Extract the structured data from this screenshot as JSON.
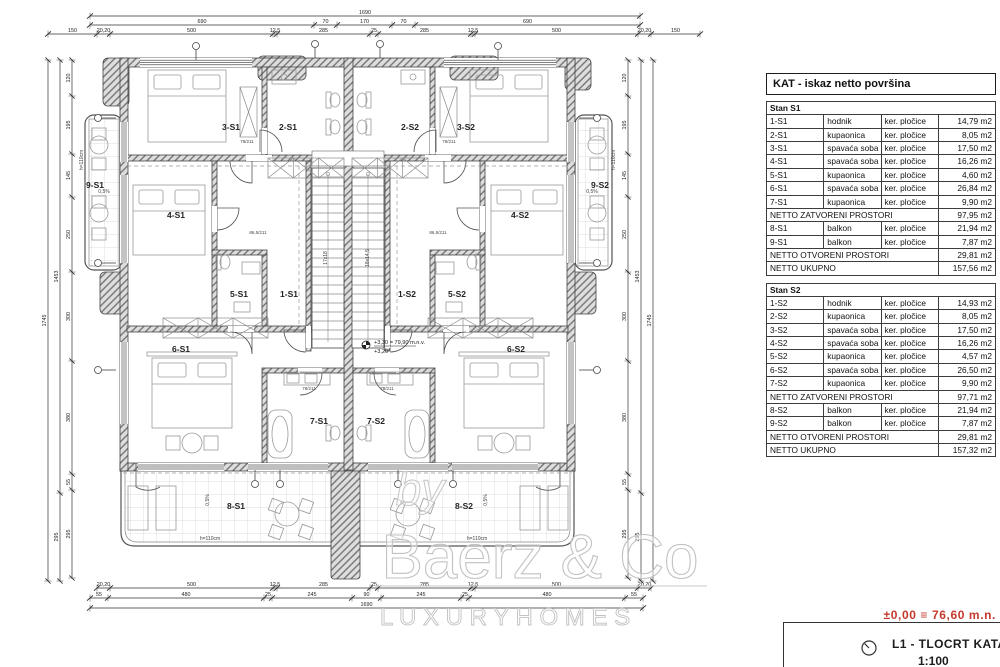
{
  "colors": {
    "benchmark_red": "#c43a2e",
    "wall_line": "#444444",
    "thin_line": "#555555"
  },
  "panel": {
    "header": "KAT - iskaz netto površina",
    "units": [
      {
        "title": "Stan S1",
        "rows": [
          {
            "code": "1-S1",
            "name": "hodnik",
            "finish": "ker. pločice",
            "area": "14,79 m2"
          },
          {
            "code": "2-S1",
            "name": "kupaonica",
            "finish": "ker. pločice",
            "area": "8,05 m2"
          },
          {
            "code": "3-S1",
            "name": "spavaća soba",
            "finish": "ker. pločice",
            "area": "17,50 m2"
          },
          {
            "code": "4-S1",
            "name": "spavaća soba",
            "finish": "ker. pločice",
            "area": "16,26 m2"
          },
          {
            "code": "5-S1",
            "name": "kupaonica",
            "finish": "ker. pločice",
            "area": "4,60 m2"
          },
          {
            "code": "6-S1",
            "name": "spavaća soba",
            "finish": "ker. pločice",
            "area": "26,84 m2"
          },
          {
            "code": "7-S1",
            "name": "kupaonica",
            "finish": "ker. pločice",
            "area": "9,90 m2"
          }
        ],
        "closed": {
          "label": "NETTO ZATVORENI PROSTORI",
          "area": "97,95 m2"
        },
        "open_rows": [
          {
            "code": "8-S1",
            "name": "balkon",
            "finish": "ker. pločice",
            "area": "21,94 m2"
          },
          {
            "code": "9-S1",
            "name": "balkon",
            "finish": "ker. pločice",
            "area": "7,87 m2"
          }
        ],
        "open": {
          "label": "NETTO OTVORENI PROSTORI",
          "area": "29,81 m2"
        },
        "total": {
          "label": "NETTO UKUPNO",
          "area": "157,56 m2"
        }
      },
      {
        "title": "Stan S2",
        "rows": [
          {
            "code": "1-S2",
            "name": "hodnik",
            "finish": "ker. pločice",
            "area": "14,93 m2"
          },
          {
            "code": "2-S2",
            "name": "kupaonica",
            "finish": "ker. pločice",
            "area": "8,05 m2"
          },
          {
            "code": "3-S2",
            "name": "spavaća soba",
            "finish": "ker. pločice",
            "area": "17,50 m2"
          },
          {
            "code": "4-S2",
            "name": "spavaća soba",
            "finish": "ker. pločice",
            "area": "16,26 m2"
          },
          {
            "code": "5-S2",
            "name": "kupaonica",
            "finish": "ker. pločice",
            "area": "4,57 m2"
          },
          {
            "code": "6-S2",
            "name": "spavaća soba",
            "finish": "ker. pločice",
            "area": "26,50 m2"
          },
          {
            "code": "7-S2",
            "name": "kupaonica",
            "finish": "ker. pločice",
            "area": "9,90 m2"
          }
        ],
        "closed": {
          "label": "NETTO ZATVORENI PROSTORI",
          "area": "97,71 m2"
        },
        "open_rows": [
          {
            "code": "8-S2",
            "name": "balkon",
            "finish": "ker. pločice",
            "area": "21,94 m2"
          },
          {
            "code": "9-S2",
            "name": "balkon",
            "finish": "ker. pločice",
            "area": "7,87 m2"
          }
        ],
        "open": {
          "label": "NETTO OTVORENI PROSTORI",
          "area": "29,81 m2"
        },
        "total": {
          "label": "NETTO UKUPNO",
          "area": "157,32 m2"
        }
      }
    ]
  },
  "plan": {
    "rooms": [
      "3-S1",
      "2-S1",
      "2-S2",
      "3-S2",
      "4-S1",
      "4-S2",
      "9-S1",
      "9-S2",
      "5-S1",
      "1-S1",
      "1-S2",
      "5-S2",
      "6-S1",
      "6-S2",
      "7-S1",
      "7-S2",
      "8-S1",
      "8-S2"
    ],
    "dims": {
      "top1": [
        "1690"
      ],
      "top2": [
        "690",
        "70",
        "170",
        "70",
        "690"
      ],
      "top3": [
        "150",
        "20,20",
        "500",
        "12,5",
        "285",
        "25",
        "285",
        "12,5",
        "500",
        "20,20",
        "150"
      ],
      "bottom1": [
        "20,20",
        "500",
        "12,5",
        "285",
        "25",
        "285",
        "12,5",
        "500",
        "20,20"
      ],
      "bottom2": [
        "55",
        "480",
        "25",
        "245",
        "90",
        "245",
        "25",
        "480",
        "55"
      ],
      "bottom3": [
        "1690"
      ],
      "side_a": [
        "120",
        "195",
        "145",
        "250",
        "300",
        "380",
        "55",
        "295"
      ],
      "side_b": [
        "1453",
        "295"
      ],
      "side_c": [
        "1745"
      ]
    },
    "notes": {
      "level": "+3,30 = 79,90 m.n.v.",
      "level2": "+3,20",
      "slope": "0,5%",
      "rail": "h=110cm",
      "stair": "17x18",
      "stair2": "18x14,5",
      "door1": "78/211",
      "door2": "86,5/211"
    }
  },
  "watermark": {
    "by": "by",
    "name": "Baerz & Co",
    "tagline": "L U X U R Y   H O M E S"
  },
  "footer": {
    "benchmark": "±0,00 ≡ 76,60 m.n.",
    "sheet_title": "L1 -  TLOCRT KATA",
    "sheet_scale": "1:100"
  }
}
